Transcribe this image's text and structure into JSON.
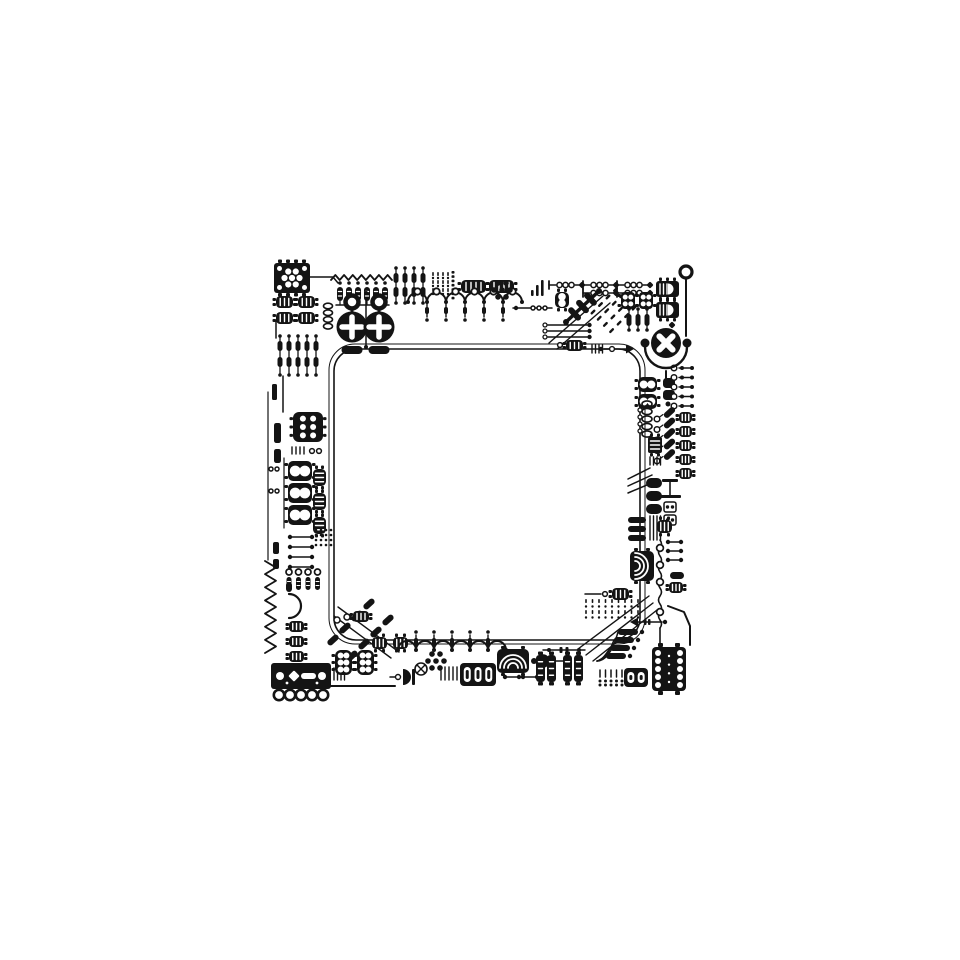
{
  "canvas": {
    "w": 960,
    "h": 960,
    "bg": "#ffffff",
    "ink": "#141414"
  },
  "illustration": {
    "kind": "circuit-board-frame",
    "interior": "empty-white-square"
  },
  "components": [
    {
      "t": "rrect",
      "x": 334,
      "y": 349,
      "w": 306,
      "h": 291,
      "r": 22,
      "sw": 1.6
    },
    {
      "t": "rrect",
      "x": 329,
      "y": 344,
      "w": 316,
      "h": 300,
      "r": 26,
      "sw": 1
    },
    {
      "t": "trace",
      "pts": [
        [
          549,
          343
        ],
        [
          603,
          296
        ]
      ],
      "sw": 1.4
    },
    {
      "t": "trace",
      "pts": [
        [
          557,
          349
        ],
        [
          610,
          303
        ]
      ],
      "sw": 1.4
    },
    {
      "t": "trace",
      "pts": [
        [
          338,
          607
        ],
        [
          399,
          652
        ]
      ],
      "sw": 1.4
    },
    {
      "t": "trace",
      "pts": [
        [
          334,
          616
        ],
        [
          391,
          658
        ]
      ],
      "sw": 1.4
    },
    {
      "t": "trace",
      "pts": [
        [
          578,
          649
        ],
        [
          649,
          596
        ]
      ],
      "sw": 1.4
    },
    {
      "t": "trace",
      "pts": [
        [
          586,
          655
        ],
        [
          653,
          603
        ]
      ],
      "sw": 1.4
    },
    {
      "t": "trace",
      "pts": [
        [
          593,
          661
        ],
        [
          657,
          610
        ]
      ],
      "sw": 1.4
    },
    {
      "t": "trace",
      "pts": [
        [
          686,
          279
        ],
        [
          686,
          336
        ]
      ],
      "sw": 2
    },
    {
      "t": "trace",
      "pts": [
        [
          666,
          371
        ],
        [
          666,
          378
        ]
      ],
      "sw": 2
    },
    {
      "t": "trace",
      "pts": [
        [
          331,
          686
        ],
        [
          395,
          686
        ]
      ],
      "sw": 2
    },
    {
      "t": "trace",
      "pts": [
        [
          310,
          277
        ],
        [
          333,
          277
        ],
        [
          338,
          283
        ]
      ],
      "sw": 1.5
    },
    {
      "t": "trace",
      "pts": [
        [
          276,
          320
        ],
        [
          276,
          338
        ]
      ],
      "sw": 1.5
    },
    {
      "t": "trace",
      "pts": [
        [
          283,
          376
        ],
        [
          283,
          412
        ]
      ],
      "sw": 1.5
    },
    {
      "t": "trace",
      "pts": [
        [
          268,
          392
        ],
        [
          268,
          560
        ]
      ],
      "sw": 1.2
    },
    {
      "t": "trace",
      "pts": [
        [
          284,
          458
        ],
        [
          284,
          528
        ]
      ],
      "sw": 1.2
    },
    {
      "t": "trace",
      "pts": [
        [
          366,
          293
        ],
        [
          366,
          347
        ]
      ],
      "sw": 1.5
    },
    {
      "t": "trace",
      "pts": [
        [
          513,
          308
        ],
        [
          552,
          308
        ]
      ],
      "sw": 1.5
    },
    {
      "t": "trace",
      "pts": [
        [
          585,
          594
        ],
        [
          601,
          594
        ]
      ],
      "sw": 1.5
    },
    {
      "t": "trace",
      "pts": [
        [
          668,
          606
        ],
        [
          684,
          612
        ],
        [
          690,
          626
        ],
        [
          690,
          645
        ]
      ],
      "sw": 2
    },
    {
      "t": "trace",
      "pts": [
        [
          549,
          661
        ],
        [
          565,
          661
        ]
      ],
      "sw": 1.5
    },
    {
      "t": "trace",
      "pts": [
        [
          628,
          479
        ],
        [
          650,
          468
        ]
      ],
      "sw": 1.5
    },
    {
      "t": "trace",
      "pts": [
        [
          628,
          486
        ],
        [
          652,
          475
        ]
      ],
      "sw": 1.5
    },
    {
      "t": "trace",
      "pts": [
        [
          628,
          493
        ],
        [
          654,
          482
        ]
      ],
      "sw": 1.5
    },
    {
      "t": "trace",
      "pts": [
        [
          660,
          628
        ],
        [
          660,
          645
        ]
      ],
      "sw": 1.6
    },
    {
      "t": "icFlower",
      "x": 274,
      "y": 263,
      "w": 36,
      "h": 30
    },
    {
      "t": "schip",
      "x": 276,
      "y": 296,
      "w": 17,
      "h": 12,
      "lp": "lr"
    },
    {
      "t": "schip",
      "x": 298,
      "y": 296,
      "w": 17,
      "h": 12,
      "lp": "lr"
    },
    {
      "t": "schip",
      "x": 276,
      "y": 312,
      "w": 17,
      "h": 12,
      "lp": "lr"
    },
    {
      "t": "schip",
      "x": 298,
      "y": 312,
      "w": 17,
      "h": 12,
      "lp": "lr"
    },
    {
      "t": "rgrid",
      "x": 280,
      "y": 341,
      "cols": 5,
      "rows": 2,
      "dx": 9,
      "dy": 16,
      "pw": 5,
      "ph": 10
    },
    {
      "t": "bar",
      "x": 272,
      "y": 384,
      "w": 5,
      "h": 16
    },
    {
      "t": "chip6",
      "x": 293,
      "y": 412,
      "w": 30,
      "h": 30
    },
    {
      "t": "bar",
      "x": 274,
      "y": 423,
      "w": 7,
      "h": 20
    },
    {
      "t": "bar",
      "x": 274,
      "y": 449,
      "w": 7,
      "h": 14
    },
    {
      "t": "comb",
      "x": 292,
      "y": 447,
      "n": 4,
      "dx": 4,
      "h": 7
    },
    {
      "t": "ring",
      "x": 312,
      "y": 451,
      "r": 2.4
    },
    {
      "t": "ring",
      "x": 319,
      "y": 451,
      "r": 2.4
    },
    {
      "t": "chip8",
      "x": 288,
      "y": 461,
      "w": 24,
      "h": 20
    },
    {
      "t": "chip8",
      "x": 288,
      "y": 483,
      "w": 24,
      "h": 20
    },
    {
      "t": "chip8",
      "x": 288,
      "y": 505,
      "w": 24,
      "h": 20
    },
    {
      "t": "ring",
      "x": 271,
      "y": 469,
      "r": 2
    },
    {
      "t": "ring",
      "x": 277,
      "y": 469,
      "r": 2
    },
    {
      "t": "ring",
      "x": 271,
      "y": 491,
      "r": 2
    },
    {
      "t": "ring",
      "x": 277,
      "y": 491,
      "r": 2
    },
    {
      "t": "schip",
      "x": 313,
      "y": 469,
      "w": 13,
      "h": 17,
      "lp": "tb"
    },
    {
      "t": "schip",
      "x": 313,
      "y": 493,
      "w": 13,
      "h": 17,
      "lp": "tb"
    },
    {
      "t": "schip",
      "x": 313,
      "y": 517,
      "w": 13,
      "h": 17,
      "lp": "tb"
    },
    {
      "t": "dumbRows",
      "x": 290,
      "y": 537,
      "rows": 4,
      "dy": 10,
      "len": 22
    },
    {
      "t": "bar",
      "x": 273,
      "y": 542,
      "w": 6,
      "h": 12
    },
    {
      "t": "bar",
      "x": 273,
      "y": 559,
      "w": 6,
      "h": 10
    },
    {
      "t": "dotGrid",
      "x": 316,
      "y": 530,
      "cols": 4,
      "rows": 4,
      "dx": 5,
      "dy": 5,
      "r": 1.3
    },
    {
      "t": "zigzag",
      "x": 265,
      "y": 561,
      "len": 92,
      "n": 7,
      "amp": 11,
      "vert": true
    },
    {
      "t": "resRingRow",
      "x": 289,
      "y": 572,
      "n": 4,
      "dx": 9.5
    },
    {
      "t": "dcircle",
      "x": 289,
      "y": 594,
      "r": 12
    },
    {
      "t": "schip",
      "x": 289,
      "y": 621,
      "w": 15,
      "h": 11,
      "lp": "lr"
    },
    {
      "t": "schip",
      "x": 289,
      "y": 636,
      "w": 15,
      "h": 11,
      "lp": "lr"
    },
    {
      "t": "schip",
      "x": 289,
      "y": 651,
      "w": 15,
      "h": 11,
      "lp": "lr"
    },
    {
      "t": "connector",
      "x": 271,
      "y": 663,
      "w": 60,
      "h": 26
    },
    {
      "t": "comb",
      "x": 334,
      "y": 668,
      "n": 4,
      "dx": 3.5,
      "h": 12
    },
    {
      "t": "diagPills",
      "x": 333,
      "y": 640,
      "n": 4,
      "step": 12,
      "ang": -42
    },
    {
      "t": "diagPills",
      "x": 352,
      "y": 656,
      "n": 4,
      "step": 12,
      "ang": -42
    },
    {
      "t": "ring",
      "x": 337,
      "y": 620,
      "r": 3
    },
    {
      "t": "ring",
      "x": 347,
      "y": 617,
      "r": 3
    },
    {
      "t": "schip",
      "x": 353,
      "y": 611,
      "w": 16,
      "h": 11,
      "lp": "lr"
    },
    {
      "t": "chip6",
      "x": 335,
      "y": 650,
      "w": 17,
      "h": 25
    },
    {
      "t": "chip6",
      "x": 357,
      "y": 650,
      "w": 17,
      "h": 25
    },
    {
      "t": "diode",
      "x": 398,
      "y": 677
    },
    {
      "t": "schip",
      "x": 372,
      "y": 637,
      "w": 15,
      "h": 12,
      "lp": "tb"
    },
    {
      "t": "schip",
      "x": 393,
      "y": 637,
      "w": 15,
      "h": 12,
      "lp": "tb"
    },
    {
      "t": "wavy",
      "x": 398,
      "y": 650,
      "n": 6,
      "r": 9,
      "stem": "up"
    },
    {
      "t": "flower",
      "x": 436,
      "y": 661,
      "r": 8,
      "n": 6,
      "dr": 2.8
    },
    {
      "t": "xring",
      "x": 421,
      "y": 669,
      "r": 6
    },
    {
      "t": "comb",
      "x": 441,
      "y": 667,
      "n": 5,
      "dx": 4,
      "h": 13
    },
    {
      "t": "pillBox",
      "x": 460,
      "y": 663,
      "w": 36,
      "h": 23,
      "slots": 3
    },
    {
      "t": "speaker",
      "x": 497,
      "y": 649,
      "w": 32,
      "h": 24,
      "dir": "up"
    },
    {
      "t": "dot",
      "x": 534,
      "y": 661,
      "r": 3
    },
    {
      "t": "halfdot",
      "x": 543,
      "y": 661,
      "r": 6
    },
    {
      "t": "dumb",
      "x": 505,
      "y": 677,
      "len": 14
    },
    {
      "t": "dumb",
      "x": 523,
      "y": 677,
      "len": 14
    },
    {
      "t": "schip",
      "x": 536,
      "y": 655,
      "w": 9,
      "h": 27,
      "lp": "tb"
    },
    {
      "t": "schip",
      "x": 547,
      "y": 655,
      "w": 9,
      "h": 27,
      "lp": "tb"
    },
    {
      "t": "schip",
      "x": 563,
      "y": 655,
      "w": 9,
      "h": 27,
      "lp": "tb"
    },
    {
      "t": "schip",
      "x": 574,
      "y": 655,
      "w": 9,
      "h": 27,
      "lp": "tb"
    },
    {
      "t": "dashChain",
      "x": 543,
      "y": 650,
      "len": 42
    },
    {
      "t": "combDots",
      "x": 600,
      "y": 670,
      "n": 5,
      "dx": 5.5
    },
    {
      "t": "pillBox",
      "x": 624,
      "y": 668,
      "w": 24,
      "h": 19,
      "slots": 2
    },
    {
      "t": "bigIC",
      "x": 652,
      "y": 647,
      "w": 34,
      "h": 44,
      "n": 5
    },
    {
      "t": "fan",
      "ox": 597,
      "oy": 661,
      "pills": [
        [
          618,
          629
        ],
        [
          614,
          637
        ],
        [
          610,
          645
        ],
        [
          606,
          653
        ]
      ]
    },
    {
      "t": "dashGrid",
      "x": 586,
      "y": 601,
      "cols": 9,
      "rows": 4,
      "dx": 6.5,
      "dy": 5.5
    },
    {
      "t": "arrowChain",
      "x": 630,
      "y": 622,
      "len": 32,
      "dir": "left"
    },
    {
      "t": "speaker",
      "x": 630,
      "y": 551,
      "w": 24,
      "h": 30,
      "dir": "right"
    },
    {
      "t": "vwavy",
      "x": 660,
      "y": 540,
      "h": 88,
      "rings": [
        548,
        565,
        582,
        612
      ]
    },
    {
      "t": "dumbRows",
      "x": 668,
      "y": 542,
      "rows": 3,
      "dy": 9,
      "len": 13
    },
    {
      "t": "pill",
      "x": 670,
      "y": 572,
      "w": 14,
      "h": 7
    },
    {
      "t": "schip",
      "x": 669,
      "y": 582,
      "w": 14,
      "h": 11,
      "lp": "lr"
    },
    {
      "t": "schip",
      "x": 612,
      "y": 588,
      "w": 17,
      "h": 12,
      "lp": "lr"
    },
    {
      "t": "ring",
      "x": 605,
      "y": 594,
      "r": 2.4
    },
    {
      "t": "chip8",
      "x": 638,
      "y": 377,
      "w": 19,
      "h": 15
    },
    {
      "t": "chip8",
      "x": 638,
      "y": 394,
      "w": 19,
      "h": 15
    },
    {
      "t": "bar",
      "x": 663,
      "y": 378,
      "w": 12,
      "h": 10
    },
    {
      "t": "bar",
      "x": 663,
      "y": 390,
      "w": 12,
      "h": 10
    },
    {
      "t": "dot",
      "x": 668,
      "y": 404,
      "r": 2.5
    },
    {
      "t": "ringDumbRows",
      "x": 674,
      "y": 368,
      "rows": 5,
      "dy": 9.5,
      "len": 18
    },
    {
      "t": "coil",
      "x": 647,
      "y": 404,
      "n": 5,
      "r": 5
    },
    {
      "t": "ringCol",
      "x": 640,
      "y": 410,
      "n": 4,
      "dy": 7,
      "r": 2
    },
    {
      "t": "diagRP",
      "x": 657,
      "y": 419,
      "rows": 5,
      "dy": 10.5
    },
    {
      "t": "schip",
      "x": 679,
      "y": 412,
      "w": 13,
      "h": 11,
      "lp": "lr"
    },
    {
      "t": "schip",
      "x": 679,
      "y": 426,
      "w": 13,
      "h": 11,
      "lp": "lr"
    },
    {
      "t": "schip",
      "x": 679,
      "y": 440,
      "w": 13,
      "h": 11,
      "lp": "lr"
    },
    {
      "t": "schip",
      "x": 679,
      "y": 454,
      "w": 13,
      "h": 11,
      "lp": "lr"
    },
    {
      "t": "schip",
      "x": 679,
      "y": 468,
      "w": 13,
      "h": 11,
      "lp": "lr"
    },
    {
      "t": "slitBox",
      "x": 648,
      "y": 437,
      "w": 14,
      "h": 16
    },
    {
      "t": "comb",
      "x": 650,
      "y": 457,
      "n": 4,
      "dx": 3.5,
      "h": 8
    },
    {
      "t": "pill",
      "x": 646,
      "y": 478,
      "w": 16,
      "h": 10
    },
    {
      "t": "pill",
      "x": 646,
      "y": 491,
      "w": 16,
      "h": 10
    },
    {
      "t": "pill",
      "x": 646,
      "y": 504,
      "w": 16,
      "h": 10
    },
    {
      "t": "padBox",
      "x": 664,
      "y": 502,
      "w": 12,
      "h": 10
    },
    {
      "t": "padBox",
      "x": 664,
      "y": 515,
      "w": 12,
      "h": 10
    },
    {
      "t": "ground",
      "x": 662,
      "y": 479
    },
    {
      "t": "pill",
      "x": 628,
      "y": 517,
      "w": 18,
      "h": 6
    },
    {
      "t": "pill",
      "x": 628,
      "y": 526,
      "w": 18,
      "h": 6
    },
    {
      "t": "pill",
      "x": 628,
      "y": 535,
      "w": 18,
      "h": 6
    },
    {
      "t": "comb",
      "x": 650,
      "y": 516,
      "n": 4,
      "dx": 3.5,
      "h": 24
    },
    {
      "t": "schip",
      "x": 657,
      "y": 520,
      "w": 15,
      "h": 13,
      "lp": "tb"
    },
    {
      "t": "xValve",
      "x": 666,
      "y": 343,
      "r": 15
    },
    {
      "t": "ringPin",
      "x": 686,
      "y": 272,
      "r": 6
    },
    {
      "t": "chain",
      "x": 549,
      "y": 285,
      "segs": 3
    },
    {
      "t": "chain",
      "x": 583,
      "y": 293,
      "segs": 2
    },
    {
      "t": "signalBars",
      "x": 531,
      "y": 296,
      "hs": [
        6,
        11,
        16
      ],
      "dx": 5
    },
    {
      "t": "chip8",
      "x": 555,
      "y": 292,
      "w": 14,
      "h": 16,
      "vert": true
    },
    {
      "t": "ladder",
      "x1": 566,
      "y1": 322,
      "x2": 599,
      "y2": 291
    },
    {
      "t": "diagDashGrid",
      "x": 593,
      "y": 312,
      "rows": 4,
      "cols": 4
    },
    {
      "t": "chipC",
      "x": 621,
      "y": 292,
      "w": 14,
      "h": 17
    },
    {
      "t": "chipC",
      "x": 639,
      "y": 292,
      "w": 14,
      "h": 17
    },
    {
      "t": "rgrid",
      "x": 629,
      "y": 314,
      "cols": 3,
      "rows": 1,
      "dx": 9,
      "dy": 14,
      "pw": 5,
      "ph": 12
    },
    {
      "t": "opamp",
      "x": 656,
      "y": 281,
      "w": 23,
      "h": 16
    },
    {
      "t": "opamp",
      "x": 656,
      "y": 302,
      "w": 23,
      "h": 16
    },
    {
      "t": "diamond",
      "x": 672,
      "y": 325,
      "s": 5
    },
    {
      "t": "traceDots",
      "x": 545,
      "y": 325,
      "len": 42
    },
    {
      "t": "traceDots",
      "x": 545,
      "y": 331,
      "len": 42
    },
    {
      "t": "traceDots",
      "x": 545,
      "y": 337,
      "len": 42
    },
    {
      "t": "schip",
      "x": 566,
      "y": 340,
      "w": 17,
      "h": 11,
      "lp": "lr"
    },
    {
      "t": "ring",
      "x": 560,
      "y": 345,
      "r": 2.4
    },
    {
      "t": "comb",
      "x": 592,
      "y": 345,
      "n": 4,
      "dx": 3.5,
      "h": 8
    },
    {
      "t": "arrowChain",
      "x": 604,
      "y": 349,
      "len": 30,
      "dir": "right"
    },
    {
      "t": "zigzag",
      "x": 331,
      "y": 280,
      "len": 61,
      "n": 7,
      "amp": 5,
      "vert": false
    },
    {
      "t": "stripedRow",
      "x": 340,
      "y": 287,
      "n": 6,
      "dx": 9
    },
    {
      "t": "key",
      "x": 352,
      "y": 297
    },
    {
      "t": "key",
      "x": 379,
      "y": 297
    },
    {
      "t": "dot",
      "x": 366,
      "y": 293,
      "r": 2
    },
    {
      "t": "dot",
      "x": 366,
      "y": 347,
      "r": 2
    },
    {
      "t": "coil",
      "x": 328,
      "y": 306,
      "n": 4,
      "r": 4.5
    },
    {
      "t": "rgrid",
      "x": 396,
      "y": 273,
      "cols": 4,
      "rows": 2,
      "dx": 9,
      "dy": 14,
      "pw": 5,
      "ph": 10
    },
    {
      "t": "dashGrid",
      "x": 433,
      "y": 274,
      "cols": 4,
      "rows": 6,
      "dx": 5,
      "dy": 4
    },
    {
      "t": "dotBarCol",
      "x": 453,
      "y": 271,
      "n": 7,
      "dy": 4.3
    },
    {
      "t": "schip",
      "x": 461,
      "y": 280,
      "w": 25,
      "h": 13,
      "lp": "lr",
      "big": true
    },
    {
      "t": "schip",
      "x": 489,
      "y": 280,
      "w": 25,
      "h": 13,
      "lp": "lr",
      "big": true
    },
    {
      "t": "wavy",
      "x": 408,
      "y": 302,
      "n": 6,
      "r": 9.5,
      "stem": "down",
      "rings": true
    },
    {
      "t": "flower",
      "x": 502,
      "y": 290,
      "r": 8,
      "n": 6,
      "dr": 2.8
    },
    {
      "t": "dot",
      "x": 516,
      "y": 308,
      "r": 2.2
    },
    {
      "t": "ring",
      "x": 533,
      "y": 308,
      "r": 2
    },
    {
      "t": "ring",
      "x": 539,
      "y": 308,
      "r": 2
    },
    {
      "t": "ring",
      "x": 545,
      "y": 308,
      "r": 2
    }
  ]
}
